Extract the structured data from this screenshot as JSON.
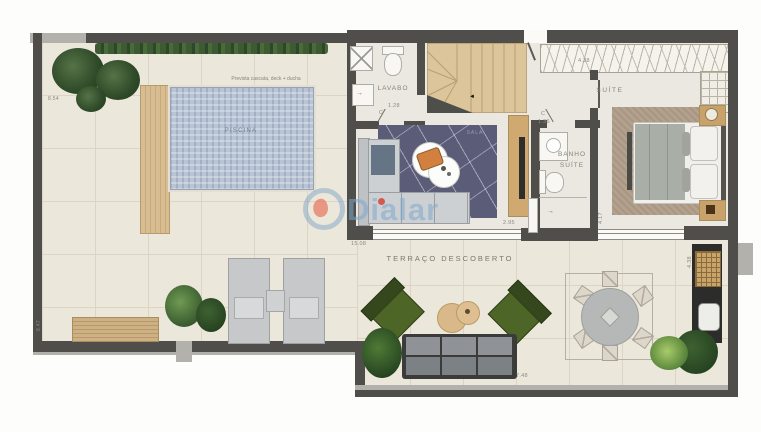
{
  "watermark": {
    "text": "Dialar"
  },
  "rooms": {
    "piscina": "PISCINA",
    "lavabo": "LAVABO",
    "sala": "SALA",
    "banho_line1": "BANHO",
    "banho_line2": "SUÍTE",
    "suite": "SUÍTE",
    "terraco": "TERRAÇO DESCOBERTO"
  },
  "notes": {
    "pool": "Prevista cascata, deck + ducha"
  },
  "door_marks": {
    "lavabo": "C",
    "banho": "C"
  },
  "dimensions": {
    "left_upper": "8.54",
    "left_lower": "8.47",
    "lavabo": "1.28",
    "suite_top": "4.38",
    "banho": "1.36",
    "terrace_left": "15.08",
    "sala_south": "2.95",
    "suite_west": "4.17",
    "terrace_south": "7.48",
    "terrace_east": "4.38"
  },
  "colors": {
    "wall": "#4f4e4a",
    "wall-light": "#b3b1ac",
    "terrace-floor": "#ece7db",
    "terrace-grid": "#ddd5c3",
    "indoor-floor": "#ebe8e1",
    "pool": "#b9c4d5",
    "wood": "#dcc59b",
    "rug-sala": "#5a5c78",
    "rug-suite": "#b2a18d",
    "green-chair": "#4d6527",
    "sofa-light": "#cdd0d2",
    "sofa-terrace": "#8f9397",
    "counter-dark": "#2c2c2a",
    "watermark": "rgba(125,168,205,0.55)",
    "accent-orange": "#d2803f"
  }
}
